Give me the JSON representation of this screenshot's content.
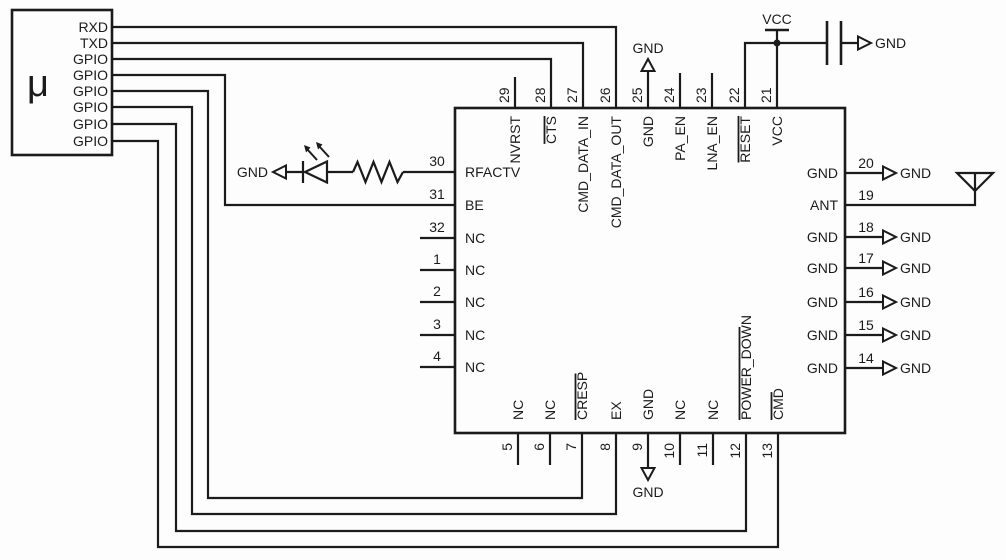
{
  "diagram": {
    "kind": "circuit-schematic",
    "background": "#fdfdfd",
    "line_color": "#1b1b1b",
    "mcu": {
      "label": "μ",
      "pins": [
        "RXD",
        "TXD",
        "GPIO",
        "GPIO",
        "GPIO",
        "GPIO",
        "GPIO",
        "GPIO"
      ]
    },
    "rf_ic": {
      "top_pins": [
        {
          "num": "29",
          "label": "NVRST",
          "overline": false
        },
        {
          "num": "28",
          "label": "CTS",
          "overline": true
        },
        {
          "num": "27",
          "label": "CMD_DATA_IN",
          "overline": false
        },
        {
          "num": "26",
          "label": "CMD_DATA_OUT",
          "overline": false
        },
        {
          "num": "25",
          "label": "GND",
          "overline": false
        },
        {
          "num": "24",
          "label": "PA_EN",
          "overline": false
        },
        {
          "num": "23",
          "label": "LNA_EN",
          "overline": false
        },
        {
          "num": "22",
          "label": "RESET",
          "overline": true
        },
        {
          "num": "21",
          "label": "VCC",
          "overline": false
        }
      ],
      "left_pins": [
        {
          "num": "30",
          "label": "RFACTV",
          "overline": false
        },
        {
          "num": "31",
          "label": "BE",
          "overline": false
        },
        {
          "num": "32",
          "label": "NC",
          "overline": false
        },
        {
          "num": "1",
          "label": "NC",
          "overline": false
        },
        {
          "num": "2",
          "label": "NC",
          "overline": false
        },
        {
          "num": "3",
          "label": "NC",
          "overline": false
        },
        {
          "num": "4",
          "label": "NC",
          "overline": false
        }
      ],
      "right_pins": [
        {
          "num": "20",
          "label": "GND",
          "overline": false,
          "terminal": "gnd"
        },
        {
          "num": "19",
          "label": "ANT",
          "overline": false,
          "terminal": "antenna"
        },
        {
          "num": "18",
          "label": "GND",
          "overline": false,
          "terminal": "gnd"
        },
        {
          "num": "17",
          "label": "GND",
          "overline": false,
          "terminal": "gnd"
        },
        {
          "num": "16",
          "label": "GND",
          "overline": false,
          "terminal": "gnd"
        },
        {
          "num": "15",
          "label": "GND",
          "overline": false,
          "terminal": "gnd"
        },
        {
          "num": "14",
          "label": "GND",
          "overline": false,
          "terminal": "gnd"
        }
      ],
      "bottom_pins": [
        {
          "num": "5",
          "label": "NC",
          "overline": false
        },
        {
          "num": "6",
          "label": "NC",
          "overline": false
        },
        {
          "num": "7",
          "label": "CRESP",
          "overline": true
        },
        {
          "num": "8",
          "label": "EX",
          "overline": false
        },
        {
          "num": "9",
          "label": "GND",
          "overline": false
        },
        {
          "num": "10",
          "label": "NC",
          "overline": false
        },
        {
          "num": "11",
          "label": "NC",
          "overline": false
        },
        {
          "num": "12",
          "label": "POWER_DOWN",
          "overline": true
        },
        {
          "num": "13",
          "label": "CMD",
          "overline": true
        }
      ]
    },
    "net_labels": {
      "vcc": "VCC",
      "gnd": "GND"
    },
    "components": {
      "led": "led-icon",
      "resistor": "resistor-icon",
      "capacitor": "capacitor-icon",
      "antenna": "antenna-icon"
    }
  }
}
